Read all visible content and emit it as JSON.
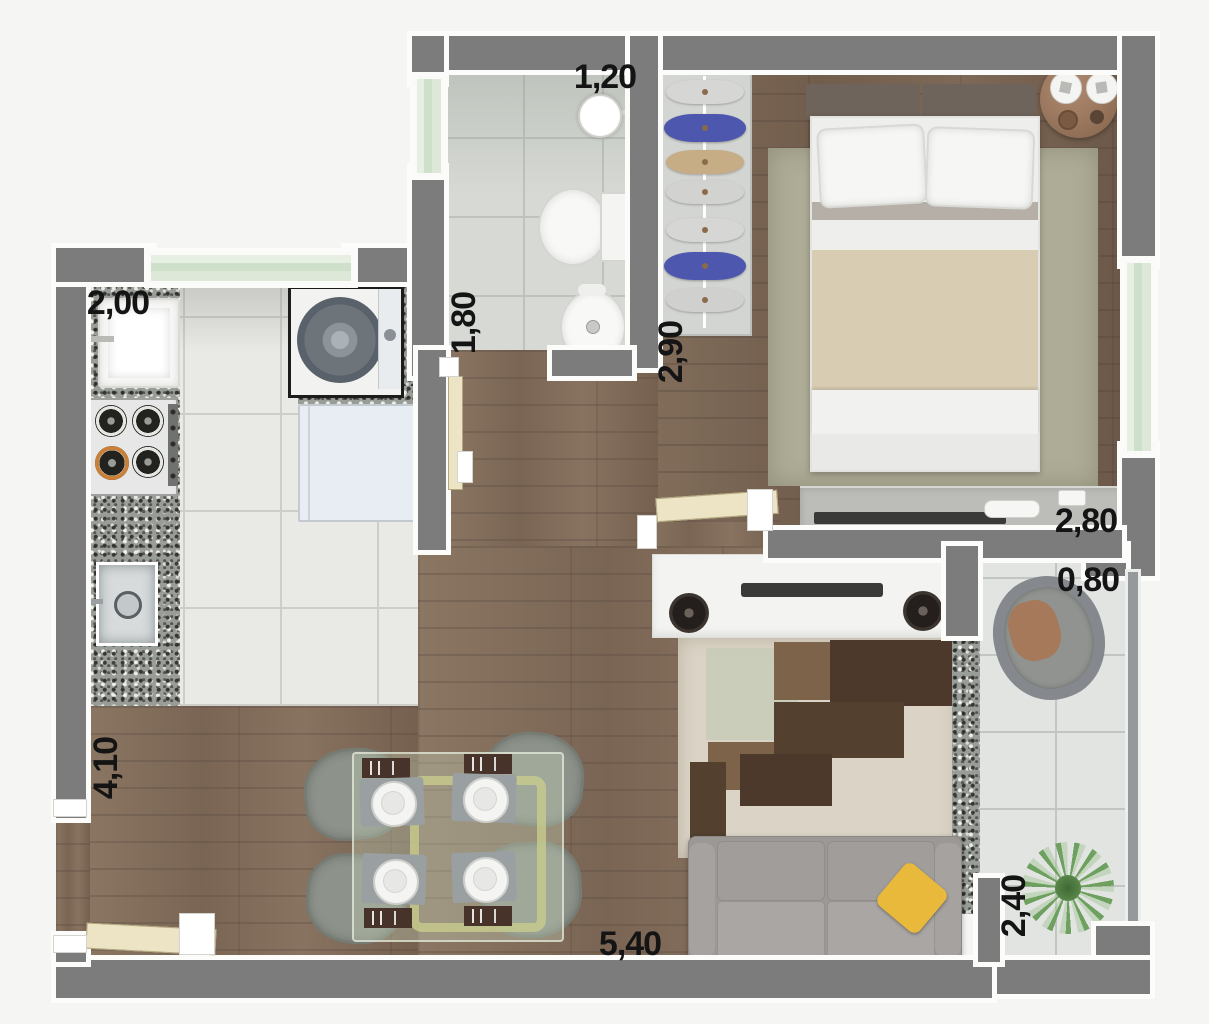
{
  "plan_title": "studio-apartment-floor-plan",
  "labels": {
    "kitchen_width": "2,00",
    "bathroom_width": "1,20",
    "bathroom_depth": "1,80",
    "closet_wall_depth": "2,90",
    "bedroom_width": "2,80",
    "balcony_width": "0,80",
    "kitchen_living_depth": "4,10",
    "living_width": "5,40",
    "balcony_depth": "2,40"
  },
  "palette": {
    "wall_gray": "#7c7c7c",
    "wall_trim_white": "#fcfcfb",
    "wood_floor": "#83705d",
    "kitchen_tile": "#e9e9e6",
    "bath_tile": "#d7d9d5",
    "balcony_tile": "#e2e4e2",
    "granite_counter": "#999d97",
    "window_glass_green": "#cfe0ca",
    "door_leaf_cream": "#ece4c4",
    "bedroom_rug_sage": "#aeac96",
    "living_rug_cream": "#dbd4c6",
    "rug_dark_brown": "#4c392b",
    "rug_mid_brown": "#7d6349",
    "sofa_gray": "#9c9895",
    "pillow_yellow": "#e8b93a",
    "closet_blue_clothes": "#4e57ae",
    "side_table_brown": "#a8826a",
    "label_black": "#141414"
  },
  "rooms": [
    "bathroom",
    "bedroom",
    "closet",
    "kitchen",
    "hallway",
    "living-dining",
    "balcony"
  ],
  "furniture_icons": [
    "shower-head-icon",
    "toilet-icon",
    "bidet-icon",
    "wardrobe-clothes-icon",
    "double-bed-icon",
    "side-table-icon",
    "dresser-tv-icon",
    "laundry-sink-icon",
    "stove-icon",
    "washing-machine-icon",
    "fridge-icon",
    "kitchen-sink-icon",
    "dining-table-icon",
    "dining-chair-icon",
    "place-setting-icon",
    "tv-stand-icon",
    "speaker-icon",
    "rug-icon",
    "sofa-icon",
    "wicker-chair-icon",
    "plant-icon"
  ]
}
